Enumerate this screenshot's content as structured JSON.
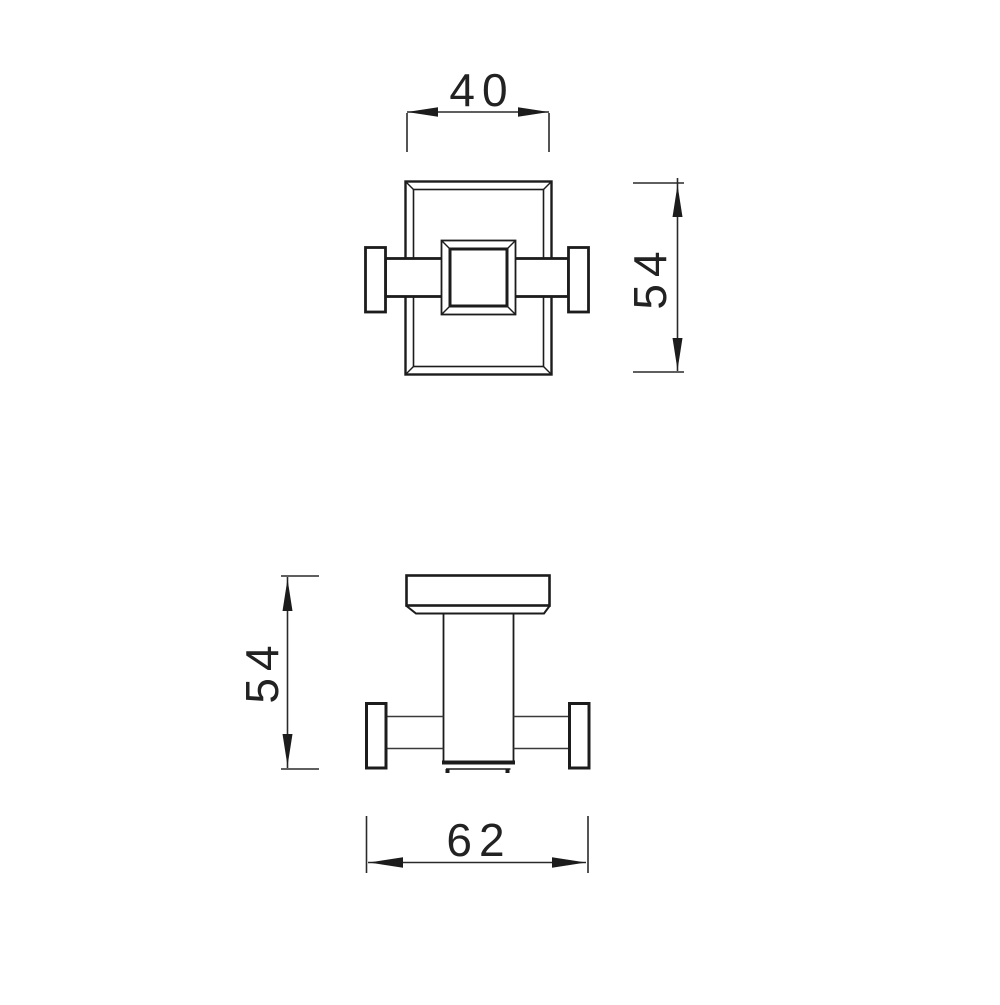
{
  "canvas": {
    "background": "#ffffff",
    "line_color": "#1c1c1c",
    "thin_line_color": "#3a3a3a"
  },
  "drawing": {
    "front_view": {
      "width_dim_label": "40",
      "height_dim_label": "54"
    },
    "side_view": {
      "height_dim_label": "54",
      "width_dim_label": "62"
    }
  }
}
